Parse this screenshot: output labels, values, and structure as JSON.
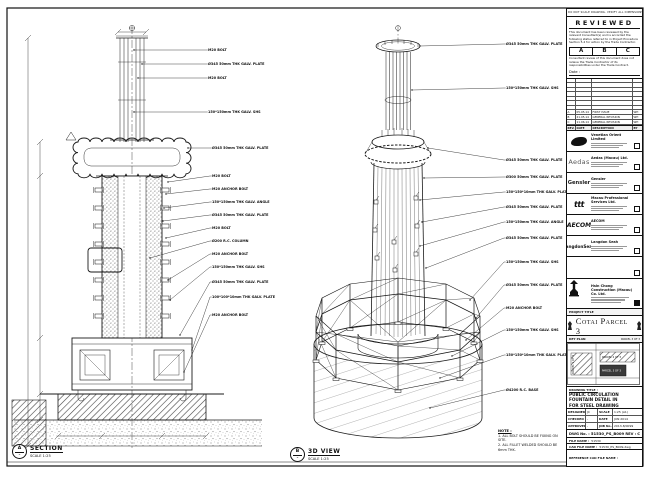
{
  "sheet": {
    "disclaimer": "DO NOT SCALE DRAWING. VERIFY ALL DIMENSIONS ON SITE. ALL DIMENSIONS IN mm.",
    "review": {
      "title": "REVIEWED",
      "para1": "This document has been reviewed by the relevant Consultant(s) and is accorded the following status referred to in Project Procedure Section 5.4 for action by the Trade Contractor.",
      "statuses": [
        "A",
        "B",
        "C"
      ],
      "para2": "Consultant review of this document does not relieve the Trade Contractor of its responsibilities under the Trade Contract.",
      "date_label": "Date :"
    },
    "revisions": {
      "headers": [
        "REV.",
        "DATE",
        "DESCRIPTION",
        "BY"
      ],
      "rows": [
        {
          "rev": "A",
          "date": "05.05.14",
          "desc": "FIRST ISSUE",
          "by": "WH"
        },
        {
          "rev": "B",
          "date": "21.05.14",
          "desc": "GENERAL REVISION",
          "by": "WH"
        },
        {
          "rev": "C",
          "date": "11.06.14",
          "desc": "GENERAL REVISION",
          "by": "WH"
        }
      ],
      "empty_rows": 7
    },
    "stakeholders": [
      {
        "logo": "venetian",
        "name": "Venetian Orient Limited"
      },
      {
        "logo": "aedas",
        "logo_text": "Aedas",
        "name": "Aedas (Macau) Ltd."
      },
      {
        "logo": "gensler",
        "logo_text": "Gensler",
        "name": "Gensler"
      },
      {
        "logo": "ttt",
        "logo_text": "ttt",
        "name": "Macau Professional Services Ltd."
      },
      {
        "logo": "aecom",
        "logo_text": "AECOM",
        "name": "AECOM"
      },
      {
        "logo": "langdonseah",
        "logo_text": "LangdonSeah",
        "name": "Langdon Seah"
      }
    ],
    "contractor": {
      "name": "Hsin Chong Construction (Macau) Co. Ltd."
    },
    "project": {
      "bar_label": "PROJECT TITLE",
      "title": "Cotai Parcel 3"
    },
    "key_plan": {
      "bar_label": "KEY PLAN",
      "parcels": [
        "PARCEL 1 OF 3",
        "PARCEL 2 OF 3",
        "PARCEL 3 OF 3"
      ]
    },
    "drawing_title": {
      "label": "DRAWING TITLE :",
      "lines": [
        "PUBLIC CIRCULATION",
        "FOUNTAIN DETAIL IN",
        "FOR STEEL DRAWING"
      ]
    },
    "info_rows": [
      {
        "k1": "DESIGNED",
        "v1": "JC",
        "k2": "SCALE",
        "v2": "1:25 (A1)"
      },
      {
        "k1": "CHECKED",
        "v1": "-",
        "k2": "DATE",
        "v2": "JUN 2014"
      },
      {
        "k1": "APPROVED",
        "v1": "-",
        "k2": "JOB No.",
        "v2": "2013-8/0099"
      }
    ],
    "dwg": {
      "label": "DWG No. :",
      "value": "51530_PS_B009",
      "rev_label": "REV :",
      "rev": "C"
    },
    "files": [
      {
        "label": "FILE NAME :",
        "value": "51530"
      },
      {
        "label": "CAD FILE NAME :",
        "value": "51530_PS_B009.dwg"
      },
      {
        "label": "REFERENCE CAD FILE NAME :",
        "value": ""
      }
    ]
  },
  "views": {
    "section": {
      "bubble": "A",
      "title": "SECTION",
      "scale": "SCALE 1:25",
      "callouts": [
        "M20 BOLT",
        "Ø345 50mm THK GALV. PLATE",
        "M20 BOLT",
        "150*150mm THK GALV. SHS",
        "Ø345 50mm THK GALV. PLATE",
        "M20 BOLT",
        "M20 ANCHOR BOLT",
        "150*150mm THK GALV. ANGLE",
        "Ø345 50mm THK GALV. PLATE",
        "M20 BOLT",
        "Ø200 R.C. COLUMN",
        "M20 ANCHOR BOLT",
        "150*150mm THK GALV. SHS",
        "Ø345 50mm THK GALV. PLATE",
        "100*100*10mm THK GALV. PLATE",
        "M20 ANCHOR BOLT"
      ]
    },
    "iso": {
      "bubble": "B",
      "title": "3D VIEW",
      "scale": "SCALE 1:25",
      "callouts": [
        "Ø345 50mm THK GALV. PLATE",
        "150*150mm THK GALV. SHS",
        "Ø345 50mm THK GALV. PLATE",
        "Ø300 50mm THK GALV. PLATE",
        "150*150*10mm THK GALV. PLATE",
        "Ø345 50mm THK GALV. PLATE",
        "150*150mm THK GALV. ANGLE",
        "Ø345 50mm THK GALV. PLATE",
        "150*150mm THK GALV. SHS",
        "Ø345 50mm THK GALV. PLATE",
        "M20 ANCHOR BOLT",
        "150*150mm THK GALV. SHS",
        "150*150*10mm THK GALV. PLATE",
        "Ø4200 R.C. BASE"
      ]
    }
  },
  "notes": {
    "title": "NOTE :",
    "items": [
      "1. ALL BOLT SHOULD BE FIXING ON SITE.",
      "2. ALL FILLET WELDED SHOULD BE 6mm THK."
    ]
  }
}
